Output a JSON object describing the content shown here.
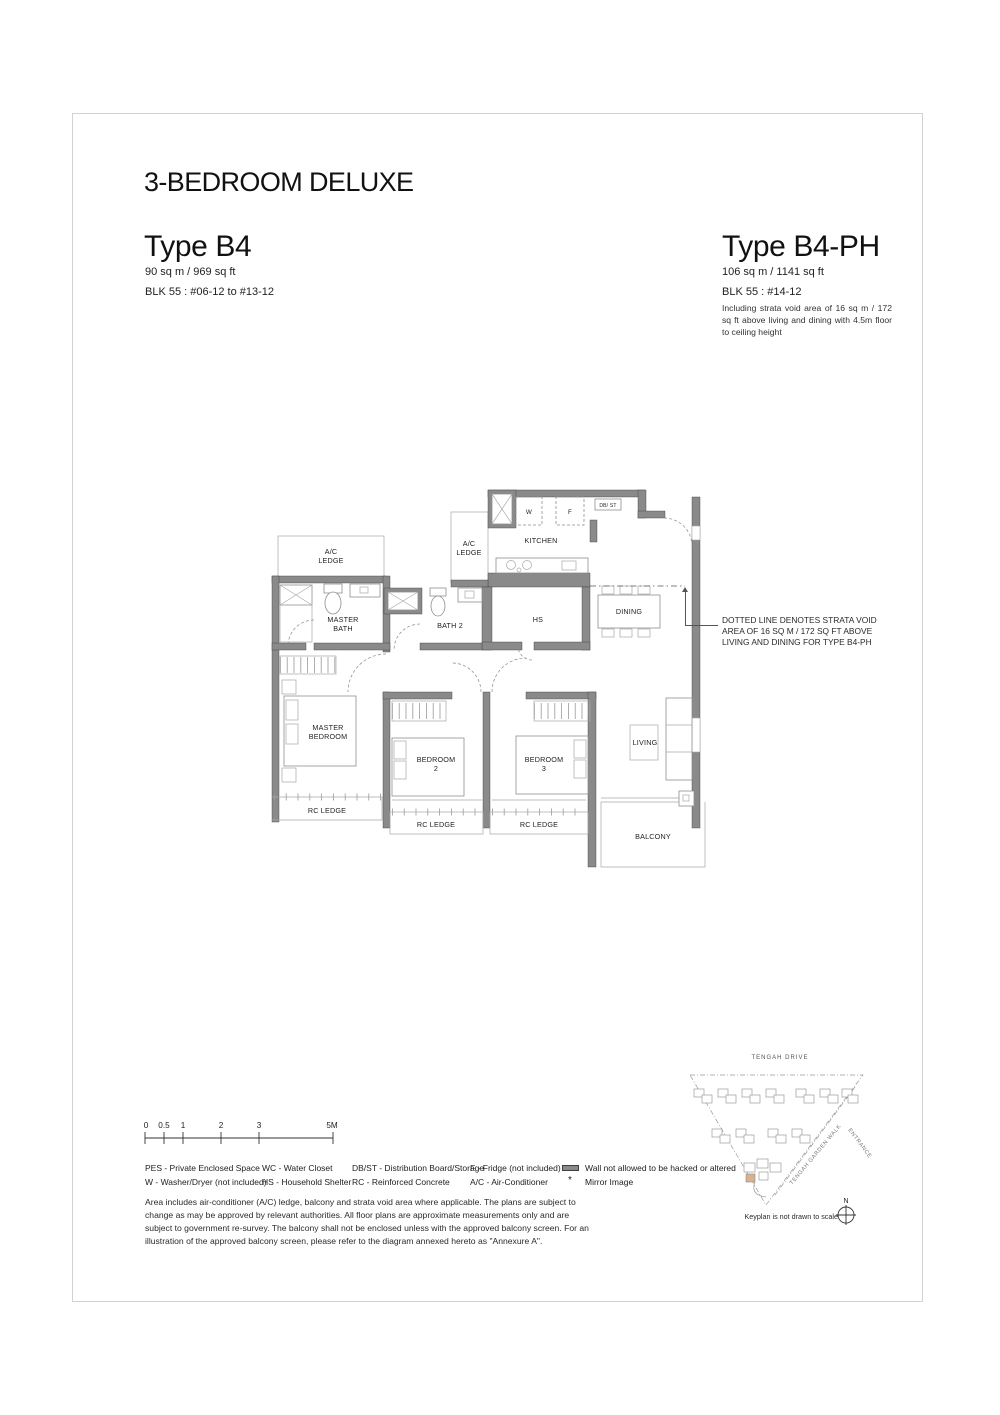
{
  "header": {
    "title": "3-BEDROOM DELUXE"
  },
  "units": {
    "b4": {
      "name": "Type B4",
      "area": "90 sq m / 969 sq ft",
      "block": "BLK 55 : #06-12 to #13-12"
    },
    "b4ph": {
      "name": "Type B4-PH",
      "area": "106 sq m / 1141 sq ft",
      "block": "BLK 55 : #14-12",
      "note": "Including strata void area of 16 sq m / 172 sq ft above living and dining with 4.5m floor to ceiling height"
    }
  },
  "floorplan": {
    "labels": {
      "ac": "A/C",
      "ledge": "LEDGE",
      "kitchen": "KITCHEN",
      "w": "W",
      "f": "F",
      "dbst": "DB/ ST",
      "master": "MASTER",
      "bath": "BATH",
      "bath2": "BATH 2",
      "hs": "HS",
      "dining": "DINING",
      "bedroom": "BEDROOM",
      "num2": "2",
      "num3": "3",
      "living": "LIVING",
      "balcony": "BALCONY",
      "rc_ledge": "RC LEDGE"
    },
    "strata_note_lines": [
      "DOTTED LINE DENOTES STRATA VOID",
      "AREA OF 16 SQ M / 172 SQ FT ABOVE",
      "LIVING AND DINING FOR TYPE B4-PH"
    ]
  },
  "scalebar": {
    "ticks": [
      "0",
      "0.5",
      "1",
      "2",
      "3",
      "5M"
    ]
  },
  "legend": {
    "items": [
      "PES - Private Enclosed Space",
      "WC - Water Closet",
      "DB/ST - Distribution Board/Storage",
      "F - Fridge (not included)",
      "W - Washer/Dryer (not included)",
      "HS - Household Shelter",
      "RC - Reinforced Concrete",
      "A/C - Air-Conditioner"
    ],
    "wall_note": "Wall not allowed to be hacked or altered",
    "mirror_symbol": "*",
    "mirror_note": "Mirror Image"
  },
  "disclaimer": "Area includes air-conditioner (A/C) ledge, balcony and strata void area where applicable. The plans are subject to change as may be approved by relevant authorities. All floor plans are approximate measurements only and are subject to government re-survey. The balcony shall not be enclosed unless with the approved balcony screen. For an illustration of the approved balcony screen, please refer to the diagram annexed hereto as \"Annexure A\".",
  "keyplan": {
    "road_top": "TENGAH  DRIVE",
    "road_walk": "TENGAH  GARDEN  WALK",
    "entrance": "ENTRANCE",
    "north": "N",
    "caption": "Keyplan is not drawn to scale"
  },
  "colors": {
    "wall": "#8a8a8a",
    "keyplan_highlight": "#d8b28e"
  }
}
